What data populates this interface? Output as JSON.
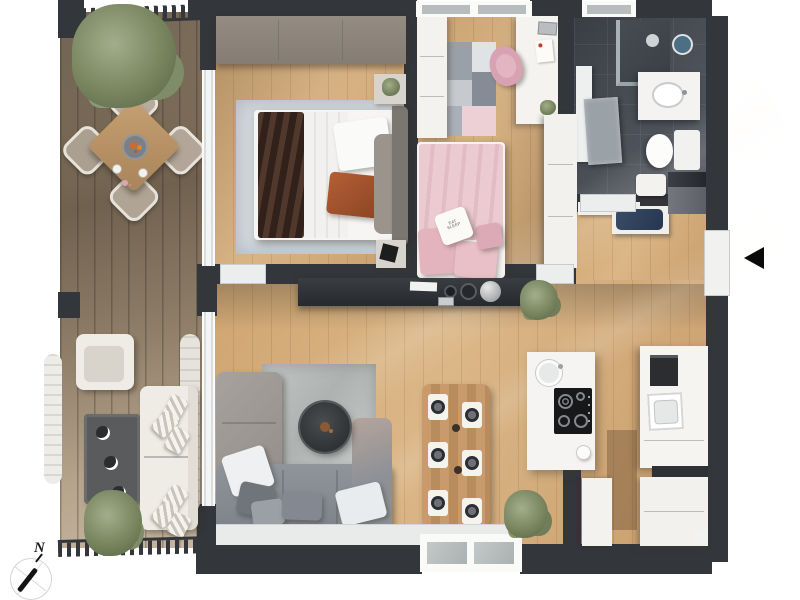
{
  "scene": {
    "type": "apartment-floor-plan-render",
    "compass": {
      "label": "N"
    },
    "entrance": {
      "marker_icon": "left-triangle"
    },
    "decor_text": {
      "bedroom2_pillow_line1": "EAT",
      "bedroom2_pillow_line2": "SLEEP"
    },
    "counts": {
      "balcony_dining_chairs": 4,
      "indoor_dining_chairs": 6,
      "dining_place_settings": 6,
      "cooktop_burners": 4
    },
    "colors": {
      "background": "#ffffff",
      "wall": "#33363a",
      "oak_floor": "#d2aa78",
      "deck_wood": "#8d7d69",
      "bathroom_tile": "#4d525a",
      "bedroom2_pink": "#eccad1",
      "sofa_gray": "#878b91",
      "living_rug_gray": "#b5b9b8",
      "bedroom1_rug": "#d1d8dc",
      "plant_green": "#78855f",
      "navy_cushion": "#2e3f57",
      "dining_table_wood": "#c29468"
    }
  }
}
